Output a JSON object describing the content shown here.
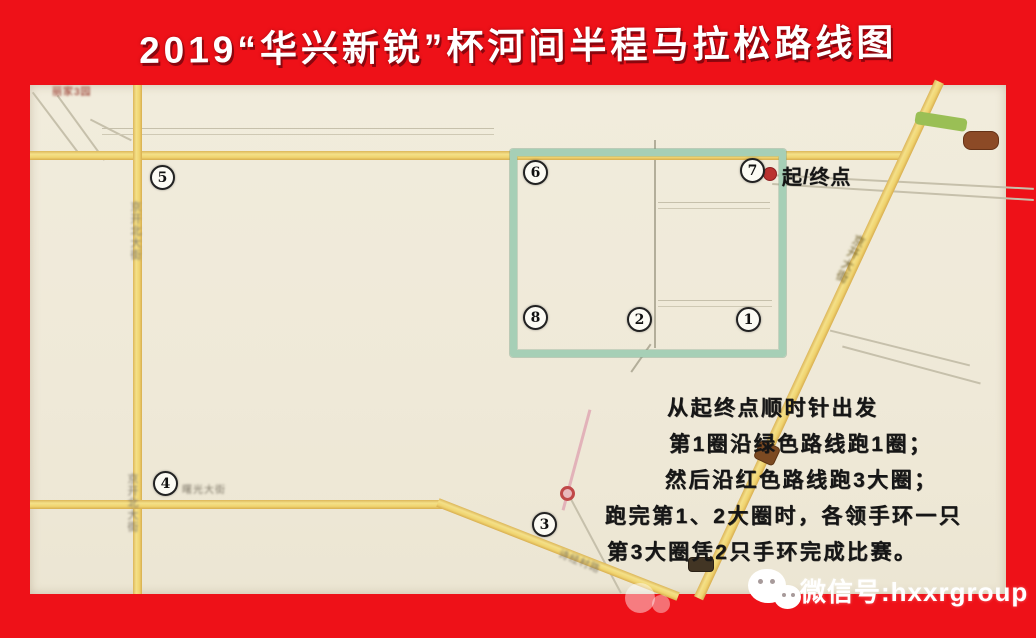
{
  "title": "2019“华兴新锐”杯河间半程马拉松路线图",
  "map": {
    "start_finish_label": "起/终点",
    "checkpoints": [
      "1",
      "2",
      "3",
      "4",
      "5",
      "6",
      "7",
      "8"
    ],
    "road_labels": {
      "west_street_upper": "京开北大街",
      "west_street_lower": "京开北大街",
      "south_street": "曙光大街",
      "southeast_road": "诗经村路",
      "highway_diagonal": "京开大街",
      "corner_area": "丽家3园"
    },
    "instructions": {
      "lines": [
        "从起终点顺时针出发",
        "第1圈沿绿色路线跑1圈；",
        "然后沿红色路线跑3大圈；",
        "跑完第1、2大圈时，各领手环一只",
        "第3大圈凭2只手环完成比赛。"
      ]
    }
  },
  "watermark": {
    "wechat_label": "微信号:hxxrgroup"
  },
  "colors": {
    "frame_red": "#ee1118",
    "map_background": "#efead9",
    "route_green": "#a6cfb6",
    "road_yellow": "#f0d470",
    "start_dot_red": "#bb3230"
  }
}
